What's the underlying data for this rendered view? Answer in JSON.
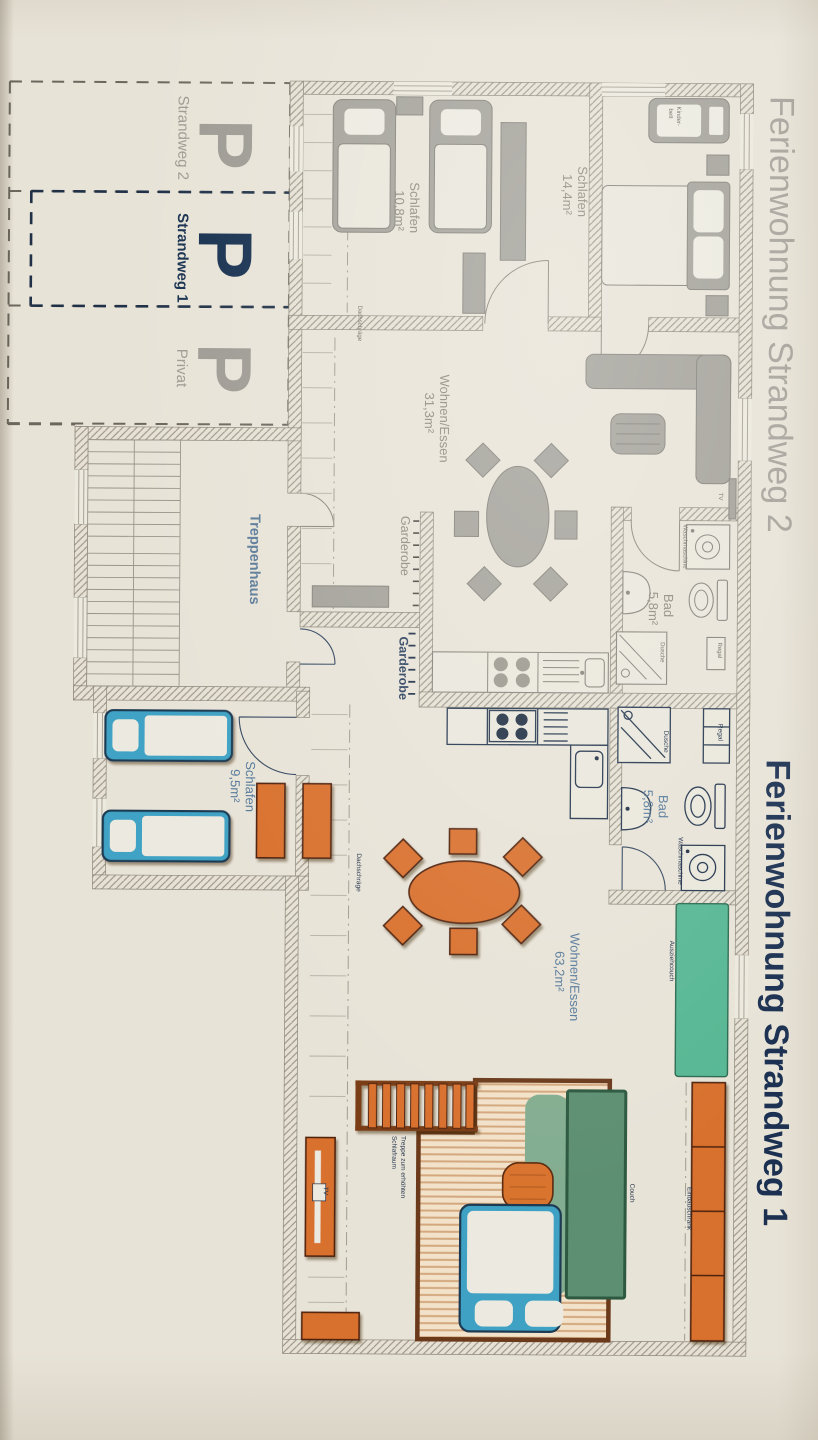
{
  "titles": {
    "apartment2": "Ferienwohnung Strandweg 2",
    "apartment1": "Ferienwohnung Strandweg 1"
  },
  "parking": {
    "spaces": [
      {
        "symbol": "P",
        "label": "Strandweg 2"
      },
      {
        "symbol": "P",
        "label": "Strandweg 1"
      },
      {
        "symbol": "P",
        "label": "Privat"
      }
    ]
  },
  "stairwell": {
    "label": "Treppenhaus"
  },
  "apartment2": {
    "bedroom1": {
      "name": "Schlafen",
      "area": "10,8m²"
    },
    "bedroom2": {
      "name": "Schlafen",
      "area": "14,4m²"
    },
    "living": {
      "name": "Wohnen/Essen",
      "area": "31,3m²"
    },
    "bath": {
      "name": "Bad",
      "area": "5,8m²"
    },
    "wardrobe": "Garderobe",
    "crib_line1": "Kinder-",
    "crib_line2": "bett",
    "washer": "Waschmaschine",
    "shower": "Dusche",
    "shelf": "Regal",
    "tv": "TV",
    "roof_slope": "Dachschräge"
  },
  "apartment1": {
    "bedroom": {
      "name": "Schlafen",
      "area": "9,5m²"
    },
    "living": {
      "name": "Wohnen/Essen",
      "area": "63,2m²"
    },
    "bath": {
      "name": "Bad",
      "area": "5,8m²"
    },
    "wardrobe": "Garderobe",
    "washer": "Waschmaschine",
    "shower": "Dusche",
    "shelf": "Regal",
    "tv": "TV",
    "sofa_bed": "Ausziehcouch",
    "built_in_closet": "Einbauschrank",
    "couch": "Couch",
    "stairs_line1": "Treppe zum erhöhten",
    "stairs_line2": "Schlafraum",
    "roof_slope": "Dachschräge"
  },
  "colors": {
    "paper": "#e8e3d7",
    "wall_gray": "#9b9588",
    "furniture_gray": "#a3a199",
    "navy": "#1c3152",
    "label_blue": "#567a9b",
    "bed_blue": "#3fa2c4",
    "accent_orange": "#d9712f",
    "sofa_teal": "#57b794",
    "couch_green": "#5d8f72",
    "wood": "#f3e2ca"
  }
}
